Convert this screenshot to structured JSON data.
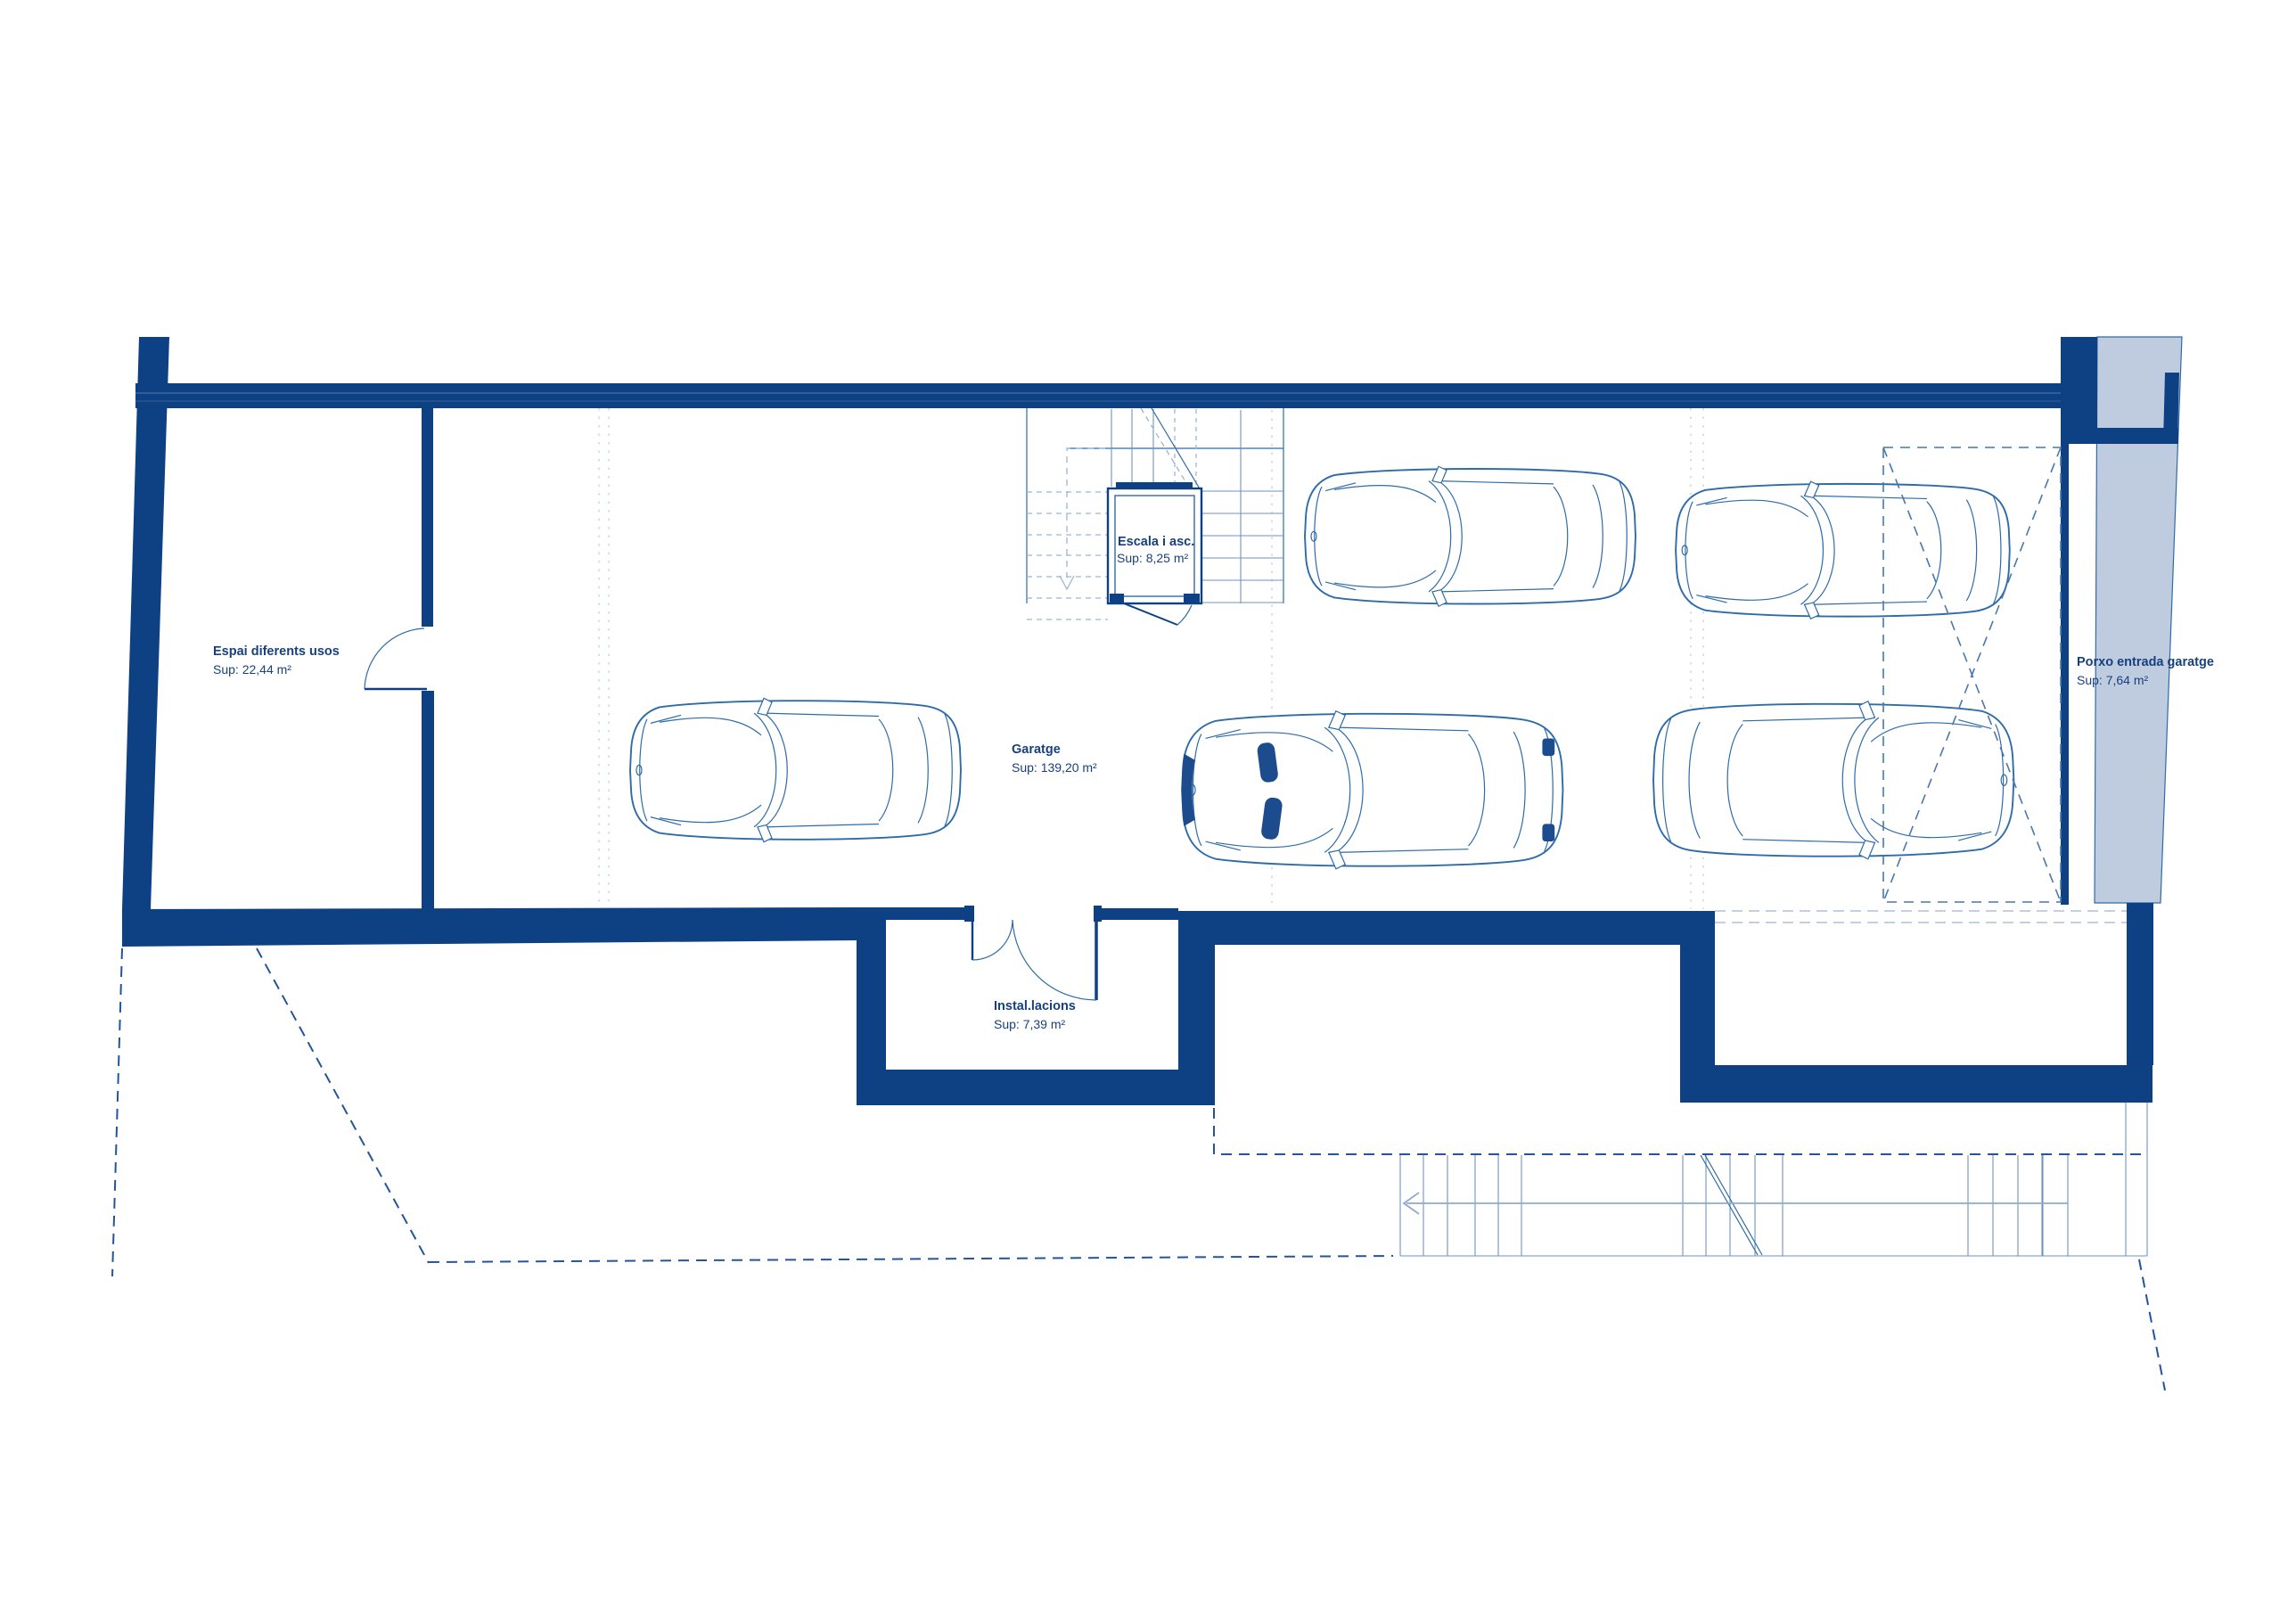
{
  "document_type": "floor-plan-blueprint",
  "language": "Catalan",
  "rooms": {
    "espai": {
      "label": "Espai diferents usos",
      "area": "Sup: 22,44 m²"
    },
    "escala": {
      "label": "Escala i asc.",
      "area": "Sup: 8,25 m²"
    },
    "garatge": {
      "label": "Garatge",
      "area": "Sup: 139,20 m²"
    },
    "installacions": {
      "label": "Instal.lacions",
      "area": "Sup: 7,39 m²"
    },
    "porxo": {
      "label": "Porxo entrada garatge",
      "area": "Sup: 7,64 m²"
    }
  },
  "cars": {
    "count": 5,
    "orientation": [
      "front-left",
      "front-left",
      "front-left",
      "front-left",
      "front-right"
    ]
  },
  "colors": {
    "wall": "#0e4184",
    "line": "#2e6ba9",
    "light_line": "#9db4d4",
    "boundary_dash": "#24549b",
    "porch_fill": "#bfcbde",
    "label_text": "#17407f",
    "background": "#ffffff"
  }
}
